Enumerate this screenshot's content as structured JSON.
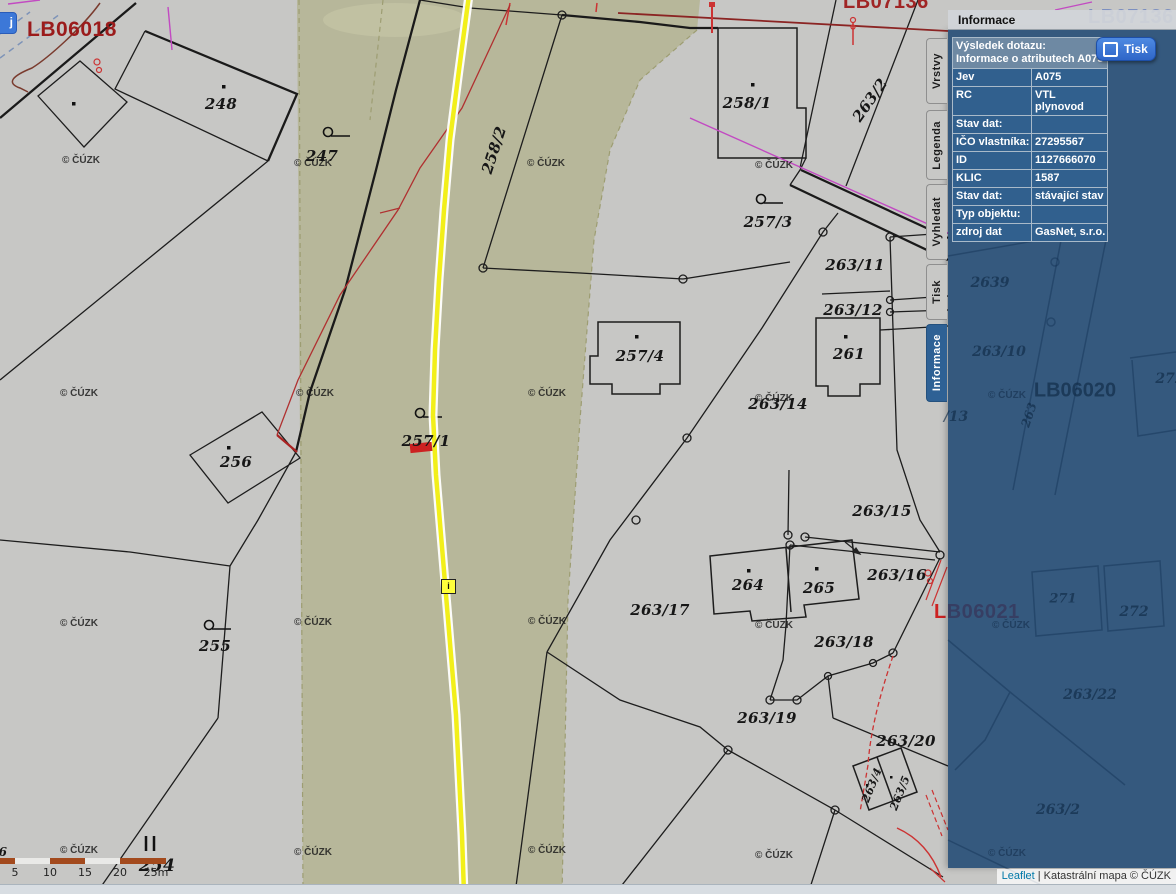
{
  "panel": {
    "title": "Informace",
    "tabs": [
      {
        "label": "Vrstvy",
        "active": false,
        "top": 38,
        "height": 66
      },
      {
        "label": "Legenda",
        "active": false,
        "top": 110,
        "height": 70
      },
      {
        "label": "Vyhledat",
        "active": false,
        "top": 184,
        "height": 76
      },
      {
        "label": "Tisk",
        "active": false,
        "top": 264,
        "height": 56
      },
      {
        "label": "Informace",
        "active": true,
        "top": 324,
        "height": 78
      }
    ],
    "print_button_label": "Tisk",
    "query": {
      "header_line1": "Výsledek dotazu:",
      "header_line2": "Informace o atributech A075",
      "rows": [
        {
          "label": "Jev",
          "value": "A075"
        },
        {
          "label": "RC",
          "value": "VTL plynovod"
        },
        {
          "label": "Stav dat:",
          "value": ""
        },
        {
          "label": "IČO vlastníka:",
          "value": "27295567"
        },
        {
          "label": "ID",
          "value": "1127666070"
        },
        {
          "label": "KLIC",
          "value": "1587"
        },
        {
          "label": "Stav dat:",
          "value": "stávající stav"
        },
        {
          "label": "Typ objektu:",
          "value": ""
        },
        {
          "label": "zdroj dat",
          "value": "GasNet, s.r.o."
        }
      ]
    }
  },
  "map": {
    "corner_button_label": "j",
    "marker_label": "i",
    "watermark_text": "© ČÚZK",
    "watermarks": [
      [
        62,
        155
      ],
      [
        294,
        158
      ],
      [
        527,
        158
      ],
      [
        755,
        160
      ],
      [
        60,
        388
      ],
      [
        296,
        388
      ],
      [
        528,
        388
      ],
      [
        755,
        393
      ],
      [
        60,
        618
      ],
      [
        294,
        617
      ],
      [
        528,
        616
      ],
      [
        755,
        620
      ],
      [
        60,
        845
      ],
      [
        294,
        847
      ],
      [
        528,
        845
      ],
      [
        755,
        850
      ]
    ],
    "sheet_labels": [
      {
        "text": "LB06018",
        "x": 27,
        "y": 18,
        "size": 21,
        "color": "#9b1b1b"
      },
      {
        "text": "LB07136",
        "x": 843,
        "y": -9,
        "size": 20,
        "color": "#a02525"
      },
      {
        "text": "LB07136",
        "x": 1088,
        "y": 6,
        "size": 20,
        "color": "#7c8fc0"
      },
      {
        "text": "LB06021",
        "x": 934,
        "y": 601,
        "size": 20,
        "color": "#cc2222"
      }
    ],
    "parcel_labels": [
      {
        "text": "248",
        "x": 221,
        "y": 104
      },
      {
        "text": "247",
        "x": 322,
        "y": 156
      },
      {
        "text": "258/2",
        "x": 494,
        "y": 150,
        "rot": -72
      },
      {
        "text": "258/1",
        "x": 747,
        "y": 103
      },
      {
        "text": "263/2",
        "x": 870,
        "y": 100,
        "rot": -55
      },
      {
        "text": "257/3",
        "x": 768,
        "y": 222
      },
      {
        "text": "263/11",
        "x": 855,
        "y": 265
      },
      {
        "text": "263/12",
        "x": 853,
        "y": 310
      },
      {
        "text": "261",
        "x": 849,
        "y": 354
      },
      {
        "text": "257/4",
        "x": 640,
        "y": 356
      },
      {
        "text": "263/14",
        "x": 778,
        "y": 404
      },
      {
        "text": "256",
        "x": 236,
        "y": 462
      },
      {
        "text": "257/1",
        "x": 426,
        "y": 441
      },
      {
        "text": "263/15",
        "x": 882,
        "y": 511
      },
      {
        "text": "264",
        "x": 748,
        "y": 585
      },
      {
        "text": "265",
        "x": 819,
        "y": 588
      },
      {
        "text": "263/16",
        "x": 897,
        "y": 575
      },
      {
        "text": "263/17",
        "x": 660,
        "y": 610
      },
      {
        "text": "263/18",
        "x": 844,
        "y": 642
      },
      {
        "text": "255",
        "x": 215,
        "y": 646
      },
      {
        "text": "263/19",
        "x": 767,
        "y": 718
      },
      {
        "text": "263/20",
        "x": 906,
        "y": 741
      },
      {
        "text": "263/4",
        "x": 872,
        "y": 785,
        "rot": -68,
        "size": 11
      },
      {
        "text": "263/5",
        "x": 900,
        "y": 793,
        "rot": -68,
        "size": 11
      },
      {
        "text": "254",
        "x": 157,
        "y": 866,
        "size": 17
      },
      {
        "text": "6",
        "x": 3,
        "y": 852,
        "size": 12
      }
    ],
    "ghost_labels": [
      {
        "text": "2639",
        "x": 990,
        "y": 283
      },
      {
        "text": "263/10",
        "x": 999,
        "y": 352
      },
      {
        "text": "LB06020",
        "x": 1075,
        "y": 391,
        "size": 20,
        "sans": true
      },
      {
        "text": "263",
        "x": 1029,
        "y": 415,
        "rot": -72,
        "size": 12
      },
      {
        "text": "/13",
        "x": 956,
        "y": 417
      },
      {
        "text": "271",
        "x": 1063,
        "y": 599,
        "size": 13
      },
      {
        "text": "272",
        "x": 1134,
        "y": 612
      },
      {
        "text": "272",
        "x": 1170,
        "y": 379
      },
      {
        "text": "263/22",
        "x": 1090,
        "y": 695
      },
      {
        "text": "263/2",
        "x": 1058,
        "y": 810
      }
    ],
    "scale_bar": {
      "ticks": [
        {
          "label": "5",
          "x": 15
        },
        {
          "label": "10",
          "x": 50
        },
        {
          "label": "15",
          "x": 85
        },
        {
          "label": "20",
          "x": 120
        },
        {
          "label": "25m",
          "x": 156
        }
      ]
    }
  },
  "attribution": {
    "leaflet": "Leaflet",
    "separator": " | ",
    "text": "Katastrální mapa © ČÚZK"
  },
  "colors": {
    "map_bg": "#c7c7c5",
    "olive_band": "#b7b79a",
    "pipeline_yellow": "#f2ef1a",
    "panel_blue": "#1e456e",
    "active_tab": "#2e6195",
    "button_blue": "#3672d9",
    "red_line": "#b03030",
    "selection_red": "#cc2121",
    "magenta_line": "#c24ac2"
  }
}
